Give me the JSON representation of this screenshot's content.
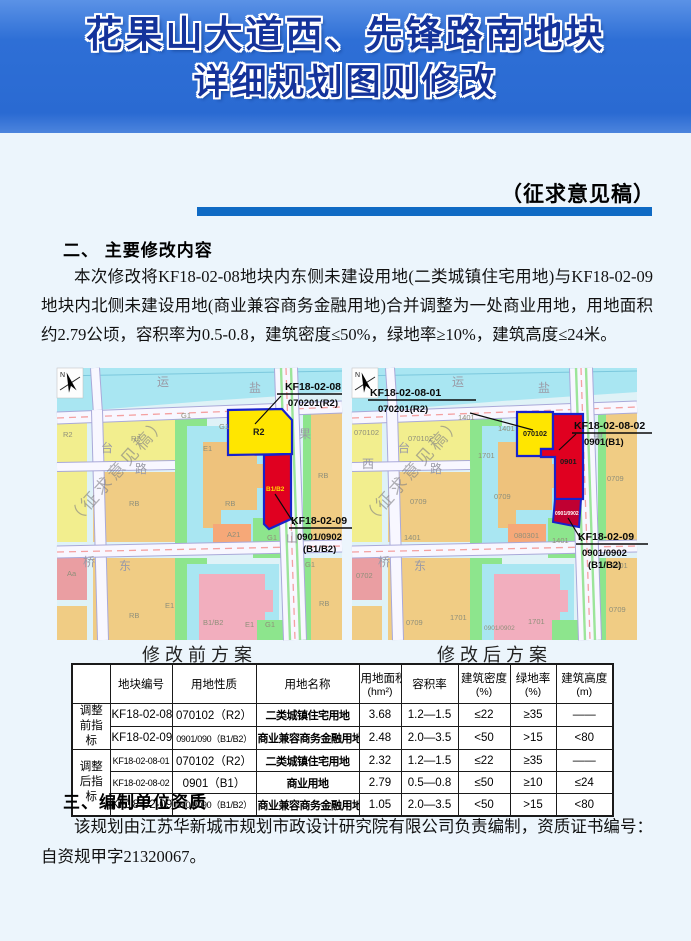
{
  "header": {
    "title_line1": "花果山大道西、先锋路南地块",
    "title_line2": "详细规划图则修改"
  },
  "page": {
    "stamp": "（征求意见稿）"
  },
  "sections": {
    "s2_heading": "二、 主要修改内容",
    "s2_paragraph": "本次修改将KF18-02-08地块内东侧未建设用地(二类城镇住宅用地)与KF18-02-09地块内北侧未建设用地(商业兼容商务金融用地)合并调整为一处商业用地，用地面积约2.79公顷，容积率为0.5-0.8，建筑密度≤50%，绿地率≥10%，建筑高度≤24米。",
    "s3_heading": "三、编制单位资质",
    "s3_paragraph": "该规划由江苏华新城市规划市政设计研究院有限公司负责编制，资质证书编号：自资规甲字21320067。"
  },
  "maps": {
    "before": {
      "caption": "修改前方案",
      "watermark": "（征求意见稿）",
      "north": "N",
      "ann": {
        "a1l1": "KF18-02-08",
        "a1l2": "070201(R2)",
        "a2l1": "KF18-02-09",
        "a2l2": "0901/0902",
        "a2l3": "(B1/B2)"
      },
      "hl": {
        "yellow": "R2",
        "red": "B1/B2"
      },
      "labels": [
        "运",
        "盐",
        "果",
        "山",
        "台",
        "路",
        "桥",
        "东",
        "R2",
        "R2",
        "G1",
        "G1",
        "E1",
        "RB",
        "RB",
        "A21",
        "G1",
        "Aa",
        "RB",
        "E1",
        "B1/B2",
        "E1",
        "G1",
        "RB",
        "G1",
        "RB"
      ]
    },
    "after": {
      "caption": "修改后方案",
      "watermark": "（征求意见稿）",
      "north": "N",
      "ann": {
        "a1l1": "KF18-02-08-01",
        "a1l2": "070201(R2)",
        "a2l1": "KF18-02-08-02",
        "a2l2": "0901(B1)",
        "a3l1": "KF18-02-09",
        "a3l2": "0901/0902",
        "a3l3": "(B1/B2)"
      },
      "hl": {
        "yellow": "070102",
        "red": "0901",
        "darkred": "0901/0902"
      },
      "labels": [
        "运",
        "盐",
        "台",
        "路",
        "西",
        "桥",
        "东",
        "果",
        "070102",
        "070102",
        "1401",
        "1401",
        "1701",
        "0709",
        "0709",
        "080301",
        "1401",
        "1401",
        "0702",
        "0709",
        "1701",
        "0901/0902",
        "1701",
        "0709",
        "0709",
        "1401"
      ]
    }
  },
  "table": {
    "columns": [
      {
        "label": ""
      },
      {
        "label": "地块编号"
      },
      {
        "label": "用地性质"
      },
      {
        "label": "用地名称"
      },
      {
        "label": "用地面积",
        "unit": "(hm²)"
      },
      {
        "label": "容积率"
      },
      {
        "label": "建筑密度",
        "unit": "(%)"
      },
      {
        "label": "绿地率",
        "unit": "(%)"
      },
      {
        "label": "建筑高度",
        "unit": "(m)"
      }
    ],
    "groups": [
      {
        "label": "调整前指标",
        "rows": [
          [
            "KF18-02-08",
            "070102（R2）",
            "二类城镇住宅用地",
            "3.68",
            "1.2—1.5",
            "≤22",
            "≥35",
            "——"
          ],
          [
            "KF18-02-09",
            "0901/090（B1/B2）",
            "商业兼容商务金融用地",
            "2.48",
            "2.0—3.5",
            "<50",
            ">15",
            "<80"
          ]
        ]
      },
      {
        "label": "调整后指标",
        "rows": [
          [
            "KF18-02-08-01",
            "070102（R2）",
            "二类城镇住宅用地",
            "2.32",
            "1.2—1.5",
            "≤22",
            "≥35",
            "——"
          ],
          [
            "KF18-02-08-02",
            "0901（B1）",
            "商业用地",
            "2.79",
            "0.5—0.8",
            "≤50",
            "≥10",
            "≤24"
          ],
          [
            "KF18-02-09",
            "0901/090（B1/B2）",
            "商业兼容商务金融用地",
            "1.05",
            "2.0—3.5",
            "<50",
            ">15",
            "<80"
          ]
        ]
      }
    ]
  }
}
